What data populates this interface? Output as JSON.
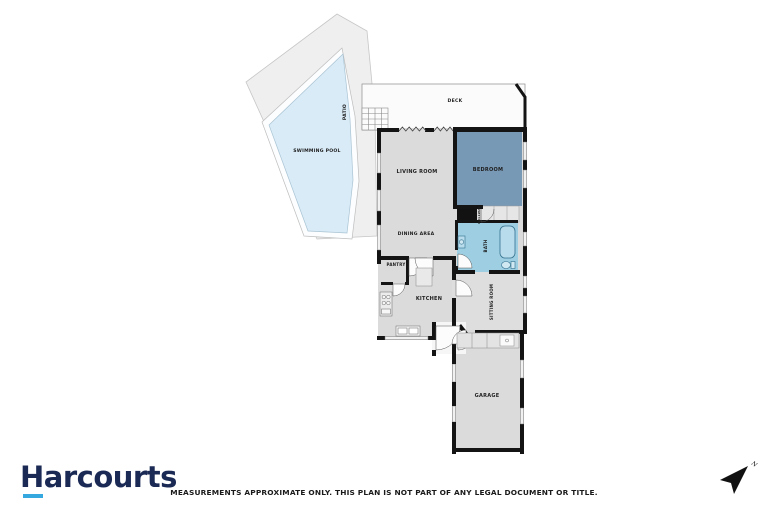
{
  "branding": {
    "name": "Harcourts"
  },
  "footer": {
    "disclaimer": "MEASUREMENTS APPROXIMATE ONLY. THIS PLAN IS NOT PART OF ANY LEGAL DOCUMENT OR TITLE."
  },
  "compass": {
    "north_label": "N"
  },
  "floorplan": {
    "rooms": {
      "swimming_pool": "SWIMMING POOL",
      "patio": "PATIO",
      "deck": "DECK",
      "living_room": "LIVING ROOM",
      "bedroom": "BEDROOM",
      "hallway": "HALLWAY",
      "dining_area": "DINING AREA",
      "bath": "BATH",
      "pantry": "PANTRY",
      "kitchen": "KITCHEN",
      "sitting_room": "SITTING ROOM",
      "garage": "GARAGE"
    },
    "colors": {
      "wall": "#141414",
      "room_fill": "#dbdbdb",
      "bedroom_fill": "#7899b6",
      "bath_fill": "#9dcee2",
      "pool_fill": "#d9ebf7",
      "patio_fill": "#efefef",
      "deck_fill": "#fbfbfb",
      "brand_navy": "#1b2a55",
      "brand_cyan": "#35a8df"
    }
  }
}
